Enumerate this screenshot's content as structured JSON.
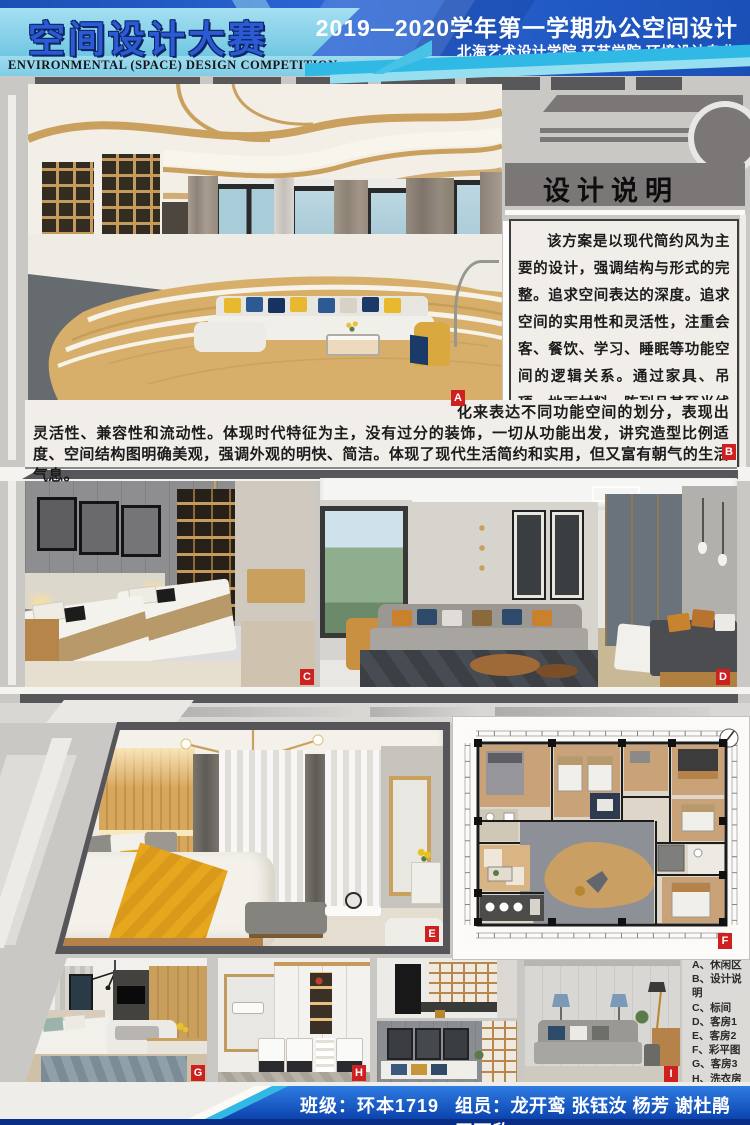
{
  "header": {
    "title_cn": "空间设计大赛",
    "title_en": "ENVIRONMENTAL (SPACE) DESIGN  COMPETITION",
    "course_line": "2019—2020学年第一学期办公空间设计",
    "school_line": "北海艺术设计学院  环艺学院  环境设计专业"
  },
  "design_statement": {
    "heading": "设计说明",
    "part1": "该方案是以现代简约风为主要的设计，强调结构与形式的完整。追求空间表达的深度。追求空间的实用性和灵活性，注重会客、餐饮、学习、睡眠等功能空间的逻辑关系。通过家具、吊顶、地面材料、陈列品甚至光线的变",
    "part2": "化来表达不同功能空间的划分，表现出灵活性、兼容性和流动性。体现时代特征为主，没有过分的装饰，一切从功能出发，讲究造型比例适度、空间结构图明确美观，强调外观的明快、简洁。体现了现代生活简约和实用，但又富有朝气的生活气息。"
  },
  "legend": {
    "items": [
      {
        "key": "A",
        "text": "A、休闲区"
      },
      {
        "key": "B",
        "text": "B、设计说明"
      },
      {
        "key": "C",
        "text": "C、标间"
      },
      {
        "key": "D",
        "text": "D、客房1"
      },
      {
        "key": "E",
        "text": "E、客房2"
      },
      {
        "key": "F",
        "text": "F、彩平图"
      },
      {
        "key": "G",
        "text": "G、客房3"
      },
      {
        "key": "H",
        "text": "H、洗衣房"
      },
      {
        "key": "I",
        "text": "I、立面图"
      }
    ]
  },
  "footer": {
    "class_label": "班级：环本1719",
    "members_label": "组员：龙开鸾  张钰汝  杨芳  谢杜鹃  王雨欣"
  },
  "colors": {
    "header_blue": "#1e5ac6",
    "cyan_accent": "#2fb9e4",
    "light_blue_band": "#8fd2ea",
    "panel_gray": "#7b7777",
    "label_red": "#cf2020",
    "wood": "#d7ae6a",
    "accent_yellow": "#e6a51e",
    "footer_blue": "#1256c4"
  }
}
